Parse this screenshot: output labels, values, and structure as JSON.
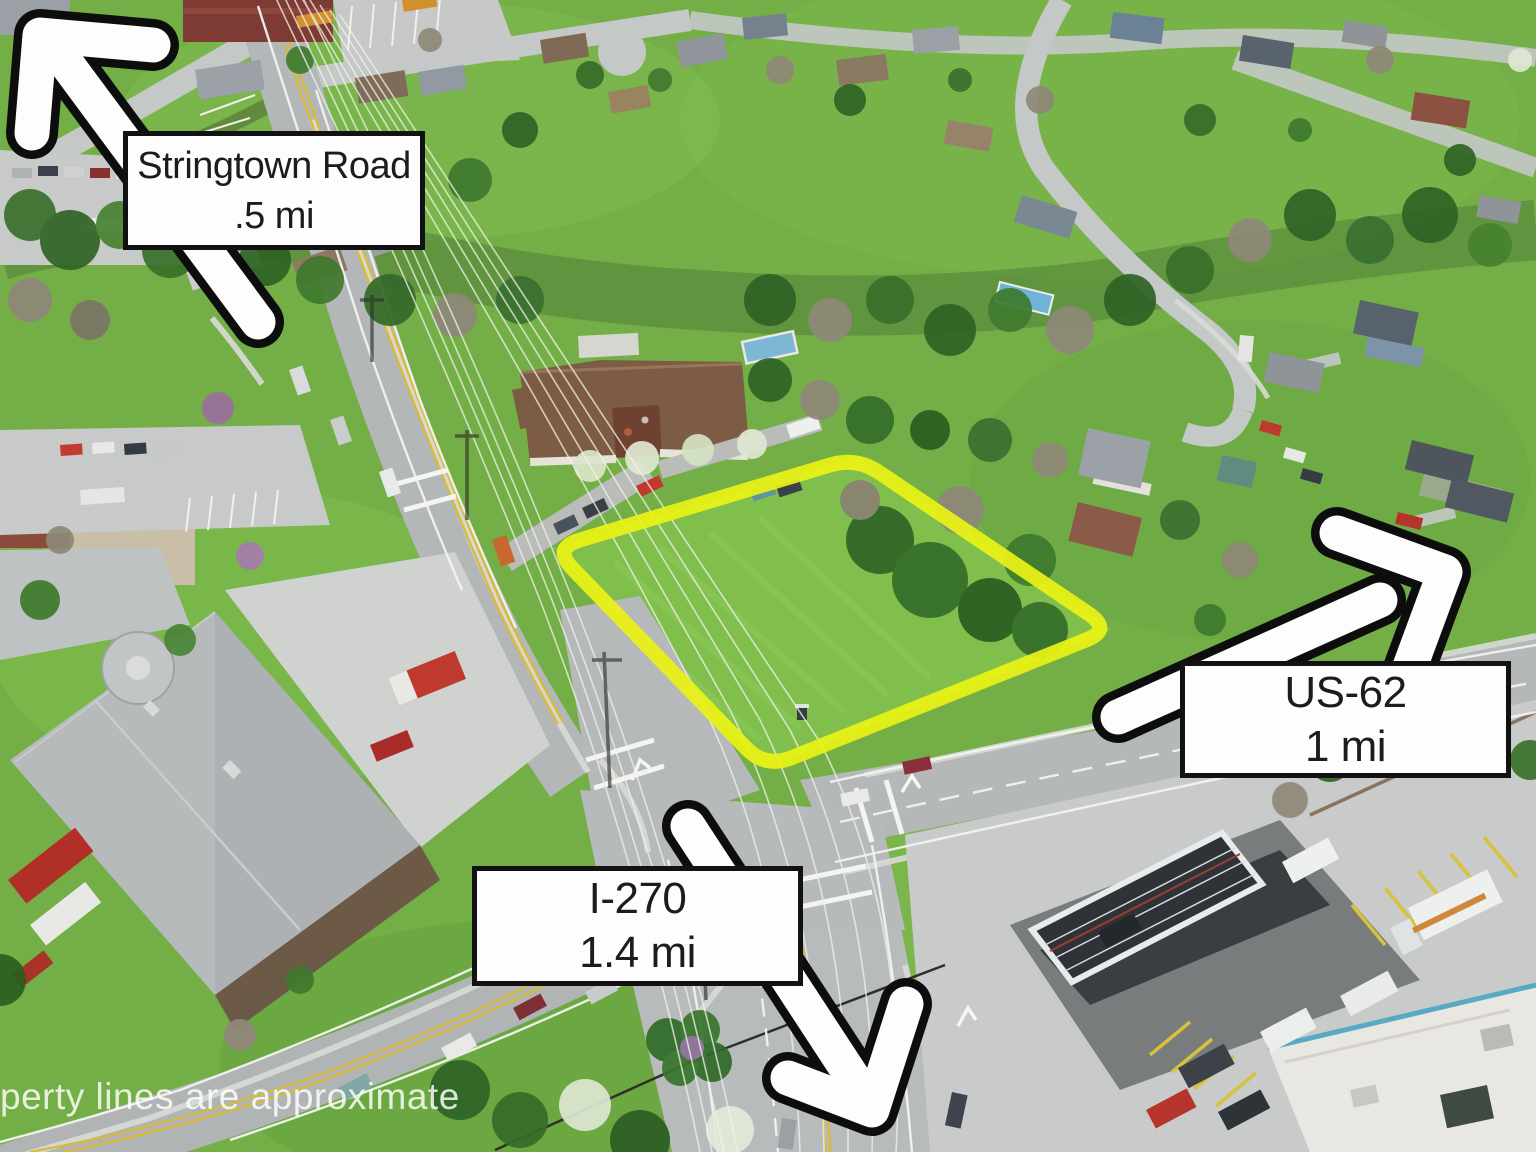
{
  "annotations": {
    "labels": [
      {
        "id": "stringtown-road",
        "title": "Stringtown Road",
        "distance": ".5 mi"
      },
      {
        "id": "us-62",
        "title": "US-62",
        "distance": "1 mi"
      },
      {
        "id": "i-270",
        "title": "I-270",
        "distance": "1.4 mi"
      }
    ],
    "watermark": "perty lines are approximate"
  },
  "colors": {
    "parcel_outline": "#eaf216",
    "arrow_fill": "#fdfdfd",
    "arrow_outline": "#0d0d0d",
    "label_background": "#fdfdfd",
    "label_border": "#121212",
    "label_text": "#1c1c1c"
  },
  "scene": {
    "type": "aerial-photo",
    "features": [
      "residential neighborhood",
      "vacant parcel outlined in yellow",
      "road intersection",
      "fire station",
      "gas station",
      "power lines"
    ]
  }
}
